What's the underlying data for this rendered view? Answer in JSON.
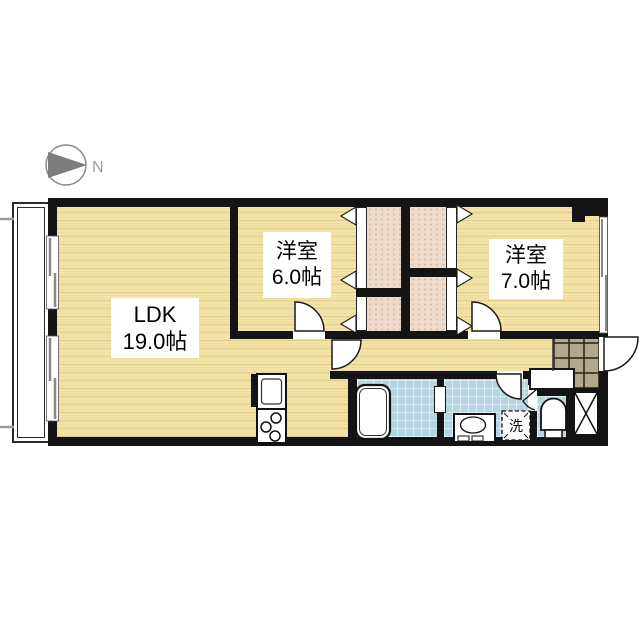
{
  "compass": {
    "label": "N"
  },
  "rooms": {
    "ldk": {
      "name": "LDK",
      "size": "19.0帖"
    },
    "bedroom_west": {
      "name": "洋室",
      "size": "6.0帖"
    },
    "bedroom_east": {
      "name": "洋室",
      "size": "7.0帖"
    }
  },
  "fixtures": {
    "laundry_label": "洗"
  },
  "colors": {
    "wood_floor": "#f2e4a9",
    "closet_floor": "#eddbce",
    "wet_area": "#b4d5e2",
    "entrance_tile": "#b4a88c",
    "wall": "#141414",
    "compass_gray": "#7d7d7d"
  }
}
